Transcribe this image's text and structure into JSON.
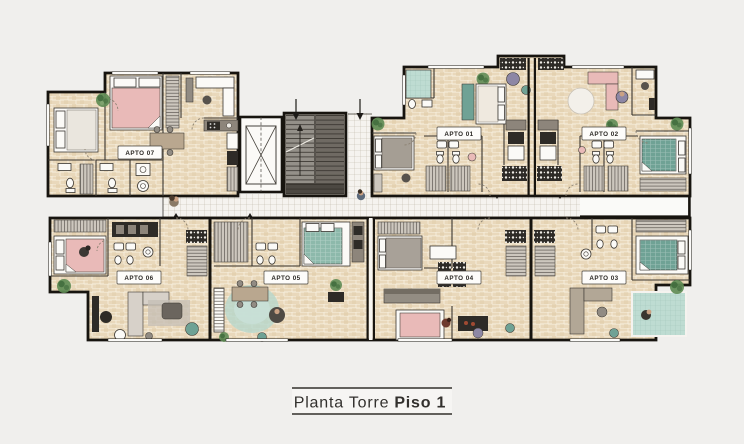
{
  "title_block": {
    "text_regular": "Planta Torre",
    "text_bold": "Piso 1"
  },
  "plan": {
    "apartments": [
      {
        "id": "apto-01",
        "label": "APTO 01"
      },
      {
        "id": "apto-02",
        "label": "APTO 02"
      },
      {
        "id": "apto-03",
        "label": "APTO 03"
      },
      {
        "id": "apto-04",
        "label": "APTO 04"
      },
      {
        "id": "apto-05",
        "label": "APTO 05"
      },
      {
        "id": "apto-06",
        "label": "APTO 06"
      },
      {
        "id": "apto-07",
        "label": "APTO 07"
      }
    ],
    "core": {
      "elevator_icon": "elevator-x-icon",
      "stairs_icon": "stairs-icon",
      "entry_arrow_icon": "down-arrow-icon"
    },
    "icons": [
      "plant-icon",
      "person-icon",
      "door-swing-icon",
      "toilet-icon",
      "sink-icon",
      "stove-icon"
    ]
  },
  "colors": {
    "bg": "#f0efed",
    "wall": "#17140f",
    "brick": "#e9d8bb",
    "brickDark": "#dfcba8",
    "mortar": "#f7f0df",
    "tile": "#f5f3ef",
    "tileLine": "#bdb5a7",
    "pink": "#e9bab8",
    "teal": "#6fa295",
    "tealLight": "#bedcd2",
    "green": "#5f8c55",
    "greenDark": "#3f6b3c",
    "grayLight": "#cdc7be",
    "gray": "#918b83",
    "grayDark": "#57524c",
    "charcoal": "#2e2b27",
    "white": "#fbfaf7",
    "wood": "#b9a78f",
    "skin": "#caa183",
    "purple": "#8d87a5",
    "rust": "#6e3a2d",
    "label": "#32302d"
  }
}
